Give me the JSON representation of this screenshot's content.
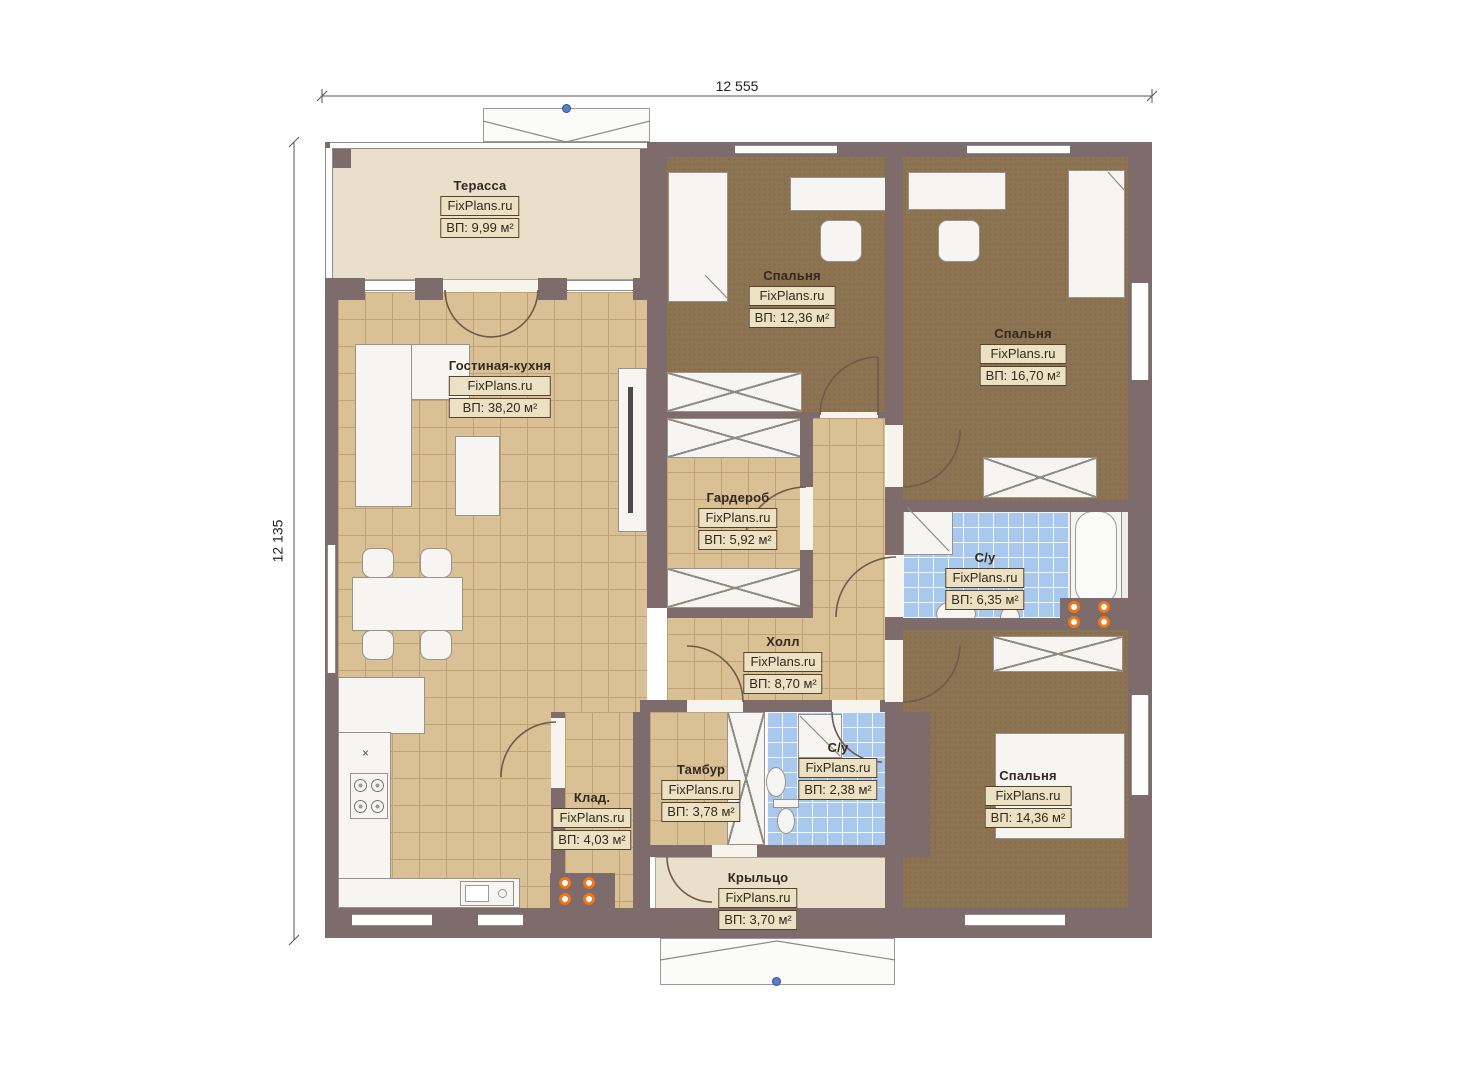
{
  "watermark": "FixPlans.ru",
  "dimensions": {
    "top": "12 555",
    "left": "12 135"
  },
  "rooms": {
    "terrace": {
      "name": "Терасса",
      "area": "ВП: 9,99 м²"
    },
    "living": {
      "name": "Гостиная-кухня",
      "area": "ВП: 38,20 м²"
    },
    "bedroom1": {
      "name": "Спальня",
      "area": "ВП: 12,36 м²"
    },
    "bedroom2": {
      "name": "Спальня",
      "area": "ВП: 16,70 м²"
    },
    "wardrobe": {
      "name": "Гардероб",
      "area": "ВП: 5,92 м²"
    },
    "bath1": {
      "name": "С/у",
      "area": "ВП: 6,35 м²"
    },
    "hall": {
      "name": "Холл",
      "area": "ВП: 8,70 м²"
    },
    "storage": {
      "name": "Клад.",
      "area": "ВП: 4,03 м²"
    },
    "tambour": {
      "name": "Тамбур",
      "area": "ВП: 3,78 м²"
    },
    "bath2": {
      "name": "С/у",
      "area": "ВП: 2,38 м²"
    },
    "bedroom3": {
      "name": "Спальня",
      "area": "ВП: 14,36 м²"
    },
    "porch": {
      "name": "Крыльцо",
      "area": "ВП: 3,70 м²"
    }
  },
  "misc": {
    "stove_mark": "×"
  },
  "colors": {
    "wall": "#7e6c6c",
    "tile": "#d9c095",
    "tile-line": "#bea275",
    "carpet": "#8c7453",
    "bath": "#a9c8ed",
    "deck": "#eadfcb",
    "deck-border": "#b3a48f",
    "furn": "#f6f5f2",
    "furn-border": "#98928a",
    "arc": "#6f5b4b",
    "accent": "#f07818",
    "dim": "#555555",
    "label-border": "#55432e",
    "label-bg": "#ece1c3",
    "marker": "#5b7fc4"
  }
}
